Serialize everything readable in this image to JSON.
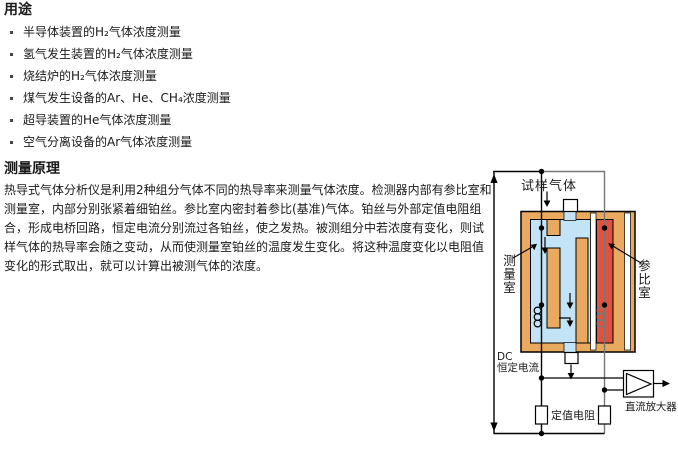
{
  "content": {
    "section1_title": "用途",
    "bullets": [
      "半导体装置的H₂气体浓度测量",
      "氢气发生装置的H₂气体浓度测量",
      "烧结炉的H₂气体浓度测量",
      "煤气发生设备的Ar、He、CH₄浓度测量",
      "超导装置的He气体浓度测量",
      "空气分离设备的Ar气体浓度测量"
    ],
    "section2_title": "测量原理",
    "paragraph": "热导式气体分析仪是利用2种组分气体不同的热导率来测量气体浓度。检测器内部有参比室和测量室，内部分别张紧着细铂丝。参比室内密封着参比(基准)气体。铂丝与外部定值电阻组合，形成电桥回路，恒定电流分别流过各铂丝，使之发热。被测组分中若浓度有变化，则试样气体的热导率会随之变动，从而使测量室铂丝的温度发生变化。将这种温度变化以电阻值变化的形式取出，就可以计算出被测气体的浓度。"
  },
  "diagram": {
    "labels": {
      "sample_gas": "试样气体",
      "measuring_cell": "测量室",
      "reference_cell": "参比室",
      "dc": "DC",
      "constant_current": "恒定电流",
      "fixed_resistor": "定值电阻",
      "dc_amplifier": "直流放大器"
    },
    "colors": {
      "block": "#E9A95E",
      "measure_channel": "#C3E3F6",
      "reference_channel": "#E0523E",
      "wire_gray": "#777777"
    }
  }
}
